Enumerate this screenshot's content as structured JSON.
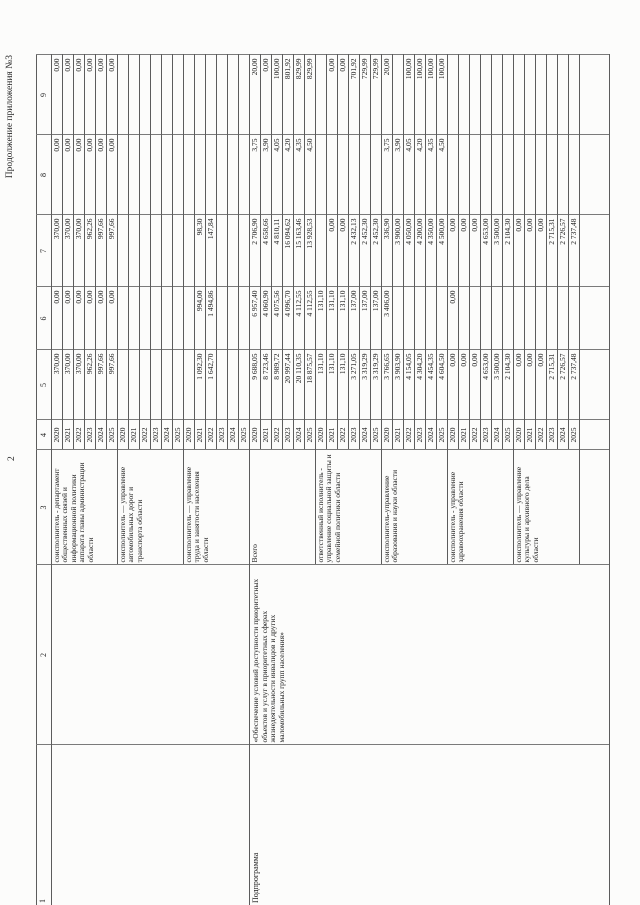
{
  "page": {
    "continuation_note": "Продолжение приложения №3",
    "page_number": "2"
  },
  "table": {
    "column_numbers": [
      "1",
      "2",
      "3",
      "4",
      "5",
      "6",
      "7",
      "8",
      "9"
    ],
    "sections": [
      {
        "program_type": "",
        "program_name": "",
        "trailing_empty_row": false,
        "blocks": [
          {
            "executor": "соисполнитель - департамент общественных связей и информационной политики аппарата главы администрации области",
            "rows": [
              [
                "2020",
                "370,00",
                "0,00",
                "370,00",
                "0,00",
                "0,00"
              ],
              [
                "2021",
                "370,00",
                "0,00",
                "370,00",
                "0,00",
                "0,00"
              ],
              [
                "2022",
                "370,00",
                "0,00",
                "370,00",
                "0,00",
                "0,00"
              ],
              [
                "2023",
                "962,26",
                "0,00",
                "962,26",
                "0,00",
                "0,00"
              ],
              [
                "2024",
                "997,66",
                "0,00",
                "997,66",
                "0,00",
                "0,00"
              ],
              [
                "2025",
                "997,66",
                "0,00",
                "997,66",
                "0,00",
                "0,00"
              ]
            ]
          },
          {
            "executor": "соисполнитель — управление автомобильных дорог и транспорта области",
            "rows": [
              [
                "2020",
                "",
                "",
                "",
                "",
                ""
              ],
              [
                "2021",
                "",
                "",
                "",
                "",
                ""
              ],
              [
                "2022",
                "",
                "",
                "",
                "",
                ""
              ],
              [
                "2023",
                "",
                "",
                "",
                "",
                ""
              ],
              [
                "2024",
                "",
                "",
                "",
                "",
                ""
              ],
              [
                "2025",
                "",
                "",
                "",
                "",
                ""
              ]
            ]
          },
          {
            "executor": "соисполнитель — управление труда и занятости населения области",
            "rows": [
              [
                "2020",
                "",
                "",
                "",
                "",
                ""
              ],
              [
                "2021",
                "1 092,30",
                "994,00",
                "98,30",
                "",
                ""
              ],
              [
                "2022",
                "1 642,70",
                "1 494,86",
                "147,84",
                "",
                ""
              ],
              [
                "2023",
                "",
                "",
                "",
                "",
                ""
              ],
              [
                "2024",
                "",
                "",
                "",
                "",
                ""
              ],
              [
                "2025",
                "",
                "",
                "",
                "",
                ""
              ]
            ]
          }
        ]
      },
      {
        "program_type": "Подпрограмма",
        "program_name": "«Обеспечение условий доступности приоритетных объектов и услуг в приоритетных сферах жизнедеятельности инвалидов и других маломобильных групп населения»",
        "trailing_empty_row": true,
        "blocks": [
          {
            "executor": "Всего",
            "rows": [
              [
                "2020",
                "9 688,05",
                "6 957,40",
                "2 706,90",
                "3,75",
                "20,00"
              ],
              [
                "2021",
                "8 723,46",
                "4 060,90",
                "4 658,66",
                "3,90",
                "0,00"
              ],
              [
                "2022",
                "8 989,72",
                "4 075,56",
                "4 810,11",
                "4,05",
                "100,00"
              ],
              [
                "2023",
                "20 997,44",
                "4 096,70",
                "16 094,62",
                "4,20",
                "801,92"
              ],
              [
                "2024",
                "20 110,35",
                "4 112,55",
                "15 163,46",
                "4,35",
                "829,99"
              ],
              [
                "2025",
                "18 875,57",
                "4 112,55",
                "13 928,53",
                "4,50",
                "829,99"
              ]
            ]
          },
          {
            "executor": "ответственный исполнитель - управление социальной защиты и семейной политики области",
            "rows": [
              [
                "2020",
                "131,10",
                "131,10",
                "",
                "",
                ""
              ],
              [
                "2021",
                "131,10",
                "131,10",
                "0,00",
                "",
                "0,00"
              ],
              [
                "2022",
                "131,10",
                "131,10",
                "0,00",
                "",
                "0,00"
              ],
              [
                "2023",
                "3 271,05",
                "137,00",
                "2 432,13",
                "",
                "701,92"
              ],
              [
                "2024",
                "3 319,29",
                "137,00",
                "2 452,30",
                "",
                "729,99"
              ],
              [
                "2025",
                "3 319,29",
                "137,00",
                "2 452,30",
                "",
                "729,99"
              ]
            ]
          },
          {
            "executor": "соисполнитель-управление образования и науки области",
            "rows": [
              [
                "2020",
                "3 766,65",
                "3 406,00",
                "336,90",
                "3,75",
                "20,00"
              ],
              [
                "2021",
                "3 903,90",
                "",
                "3 900,00",
                "3,90",
                ""
              ],
              [
                "2022",
                "4 154,05",
                "",
                "4 050,00",
                "4,05",
                "100,00"
              ],
              [
                "2023",
                "4 304,20",
                "",
                "4 200,00",
                "4,20",
                "100,00"
              ],
              [
                "2024",
                "4 454,35",
                "",
                "4 350,00",
                "4,35",
                "100,00"
              ],
              [
                "2025",
                "4 604,50",
                "",
                "4 500,00",
                "4,50",
                "100,00"
              ]
            ]
          },
          {
            "executor": "соисполнитель - управление здравоохранения области",
            "rows": [
              [
                "2020",
                "0,00",
                "0,00",
                "0,00",
                "",
                ""
              ],
              [
                "2021",
                "0,00",
                "",
                "0,00",
                "",
                ""
              ],
              [
                "2022",
                "0,00",
                "",
                "0,00",
                "",
                ""
              ],
              [
                "2023",
                "4 653,00",
                "",
                "4 653,00",
                "",
                ""
              ],
              [
                "2024",
                "3 500,00",
                "",
                "3 500,00",
                "",
                ""
              ],
              [
                "2025",
                "2 104,30",
                "",
                "2 104,30",
                "",
                ""
              ]
            ]
          },
          {
            "executor": "соисполнитель — управление культуры и архивного дела области",
            "rows": [
              [
                "2020",
                "0,00",
                "",
                "0,00",
                "",
                ""
              ],
              [
                "2021",
                "0,00",
                "",
                "0,00",
                "",
                ""
              ],
              [
                "2022",
                "0,00",
                "",
                "0,00",
                "",
                ""
              ],
              [
                "2023",
                "2 715,31",
                "",
                "2 715,31",
                "",
                ""
              ],
              [
                "2024",
                "2 726,57",
                "",
                "2 726,57",
                "",
                ""
              ],
              [
                "2025",
                "2 737,48",
                "",
                "2 737,48",
                "",
                ""
              ]
            ]
          }
        ]
      }
    ]
  }
}
